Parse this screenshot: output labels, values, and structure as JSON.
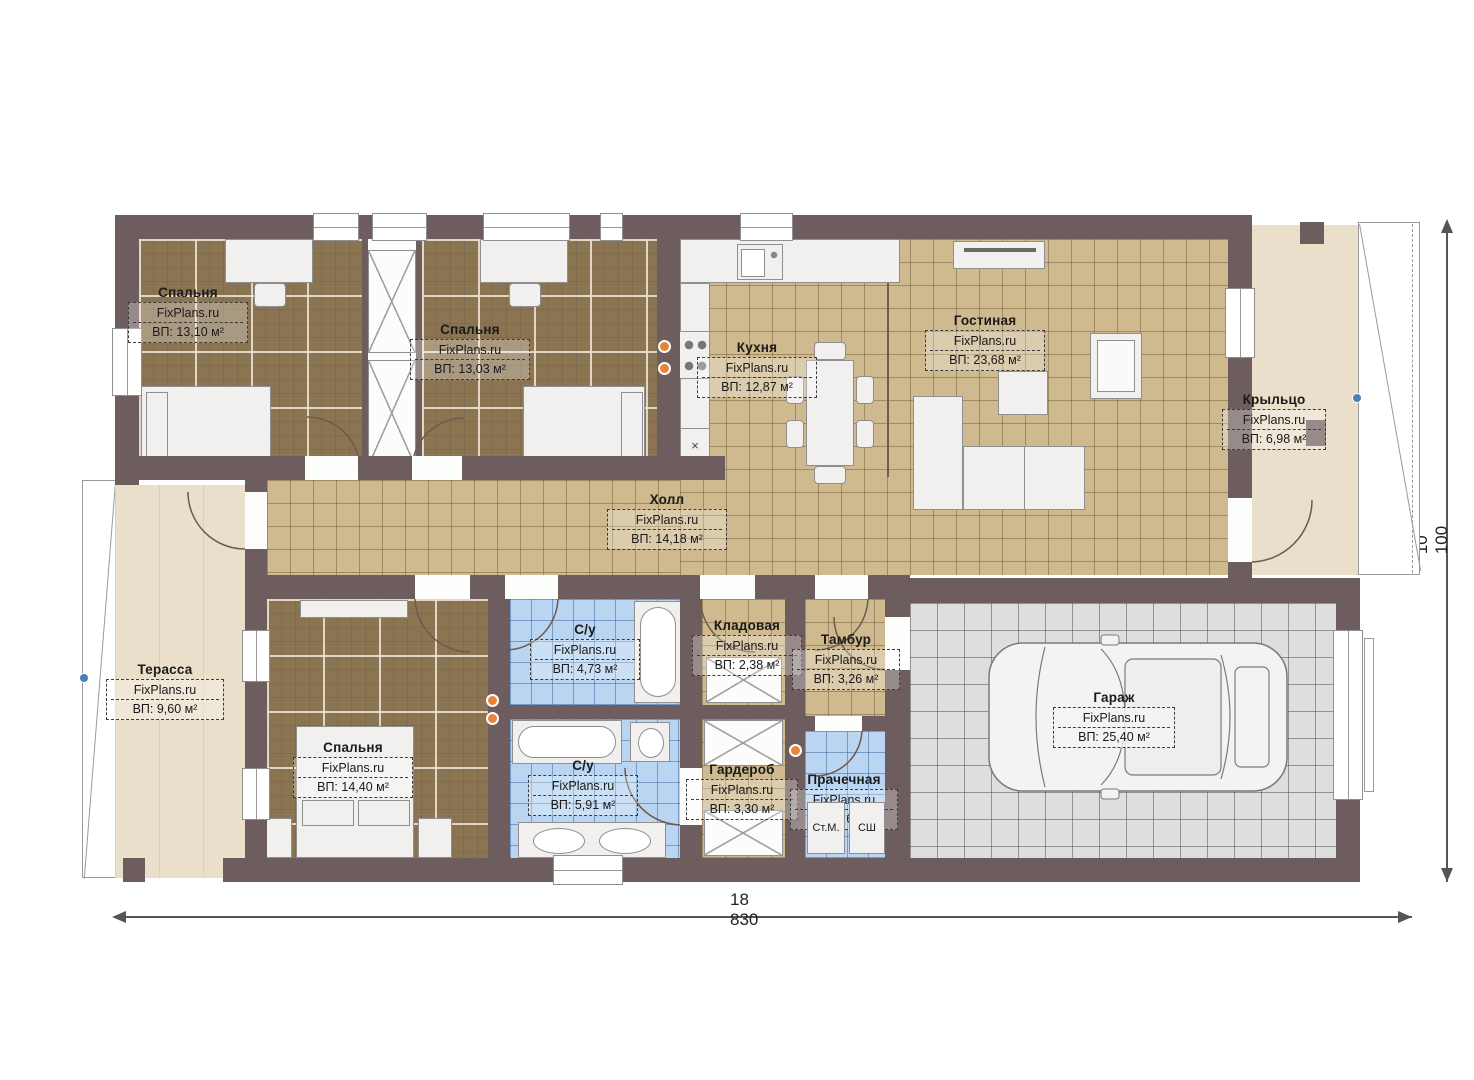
{
  "brand": "FixPlans.ru",
  "dimensions": {
    "width": "18 830",
    "height": "10 100"
  },
  "rooms": [
    {
      "id": "bedroom-1",
      "name": "Спальня",
      "area": "ВП: 13,10 м²"
    },
    {
      "id": "bedroom-2",
      "name": "Спальня",
      "area": "ВП: 13,03 м²"
    },
    {
      "id": "kitchen",
      "name": "Кухня",
      "area": "ВП: 12,87 м²"
    },
    {
      "id": "living-room",
      "name": "Гостиная",
      "area": "ВП: 23,68 м²"
    },
    {
      "id": "porch",
      "name": "Крыльцо",
      "area": "ВП: 6,98 м²"
    },
    {
      "id": "hall",
      "name": "Холл",
      "area": "ВП: 14,18 м²"
    },
    {
      "id": "terrace",
      "name": "Терасса",
      "area": "ВП: 9,60 м²"
    },
    {
      "id": "bedroom-3",
      "name": "Спальня",
      "area": "ВП: 14,40 м²"
    },
    {
      "id": "bathroom-1",
      "name": "С/у",
      "area": "ВП: 4,73 м²"
    },
    {
      "id": "pantry",
      "name": "Кладовая",
      "area": "ВП: 2,38 м²"
    },
    {
      "id": "vestibule",
      "name": "Тамбур",
      "area": "ВП: 3,26 м²"
    },
    {
      "id": "bathroom-2",
      "name": "С/у",
      "area": "ВП: 5,91 м²"
    },
    {
      "id": "wardrobe",
      "name": "Гардероб",
      "area": "ВП: 3,30 м²"
    },
    {
      "id": "laundry",
      "name": "Прачечная",
      "area": "ВП: 3,60 м²"
    },
    {
      "id": "garage",
      "name": "Гараж",
      "area": "ВП: 25,40 м²"
    }
  ],
  "appliances": {
    "washing_machine": "Ст.М.",
    "drying_cabinet": "СШ"
  },
  "symbols": {
    "dishwasher": "×"
  },
  "colors": {
    "wall": "#6e5d5f",
    "accent_orange": "#e8833a",
    "accent_blue": "#4a7fb5"
  }
}
